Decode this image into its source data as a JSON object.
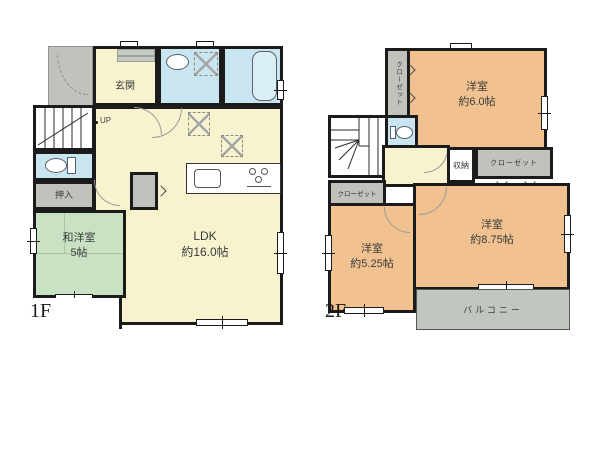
{
  "floor1": {
    "label": "1F",
    "rooms": {
      "genkan": {
        "name": "玄関"
      },
      "ldk": {
        "name": "LDK",
        "size": "約16.0帖"
      },
      "washitsu": {
        "name": "和洋室",
        "size": "5帖"
      },
      "oshiire": {
        "name": "押入"
      }
    },
    "stairs": {
      "direction": "UP"
    }
  },
  "floor2": {
    "label": "2F",
    "rooms": {
      "bedroom6": {
        "name": "洋室",
        "size": "約6.0帖"
      },
      "bedroom525": {
        "name": "洋室",
        "size": "約5.25帖"
      },
      "bedroom875": {
        "name": "洋室",
        "size": "約8.75帖"
      },
      "closet_top": {
        "name": "クローゼット"
      },
      "closet_mid": {
        "name": "クローゼット"
      },
      "closet_left": {
        "name": "クローゼット"
      },
      "storage": {
        "name": "収納"
      },
      "balcony": {
        "name": "バルコニー"
      }
    },
    "stairs": {
      "direction": "DN"
    }
  },
  "colors": {
    "wall": "#1b1b1b",
    "ldk_cream": "#f8f3cf",
    "bedroom_tan": "#f1c28f",
    "washitsu_green": "#c9e2c3",
    "wet_area_blue": "#c9e6f0",
    "closet_gray": "#bfc3bc"
  }
}
